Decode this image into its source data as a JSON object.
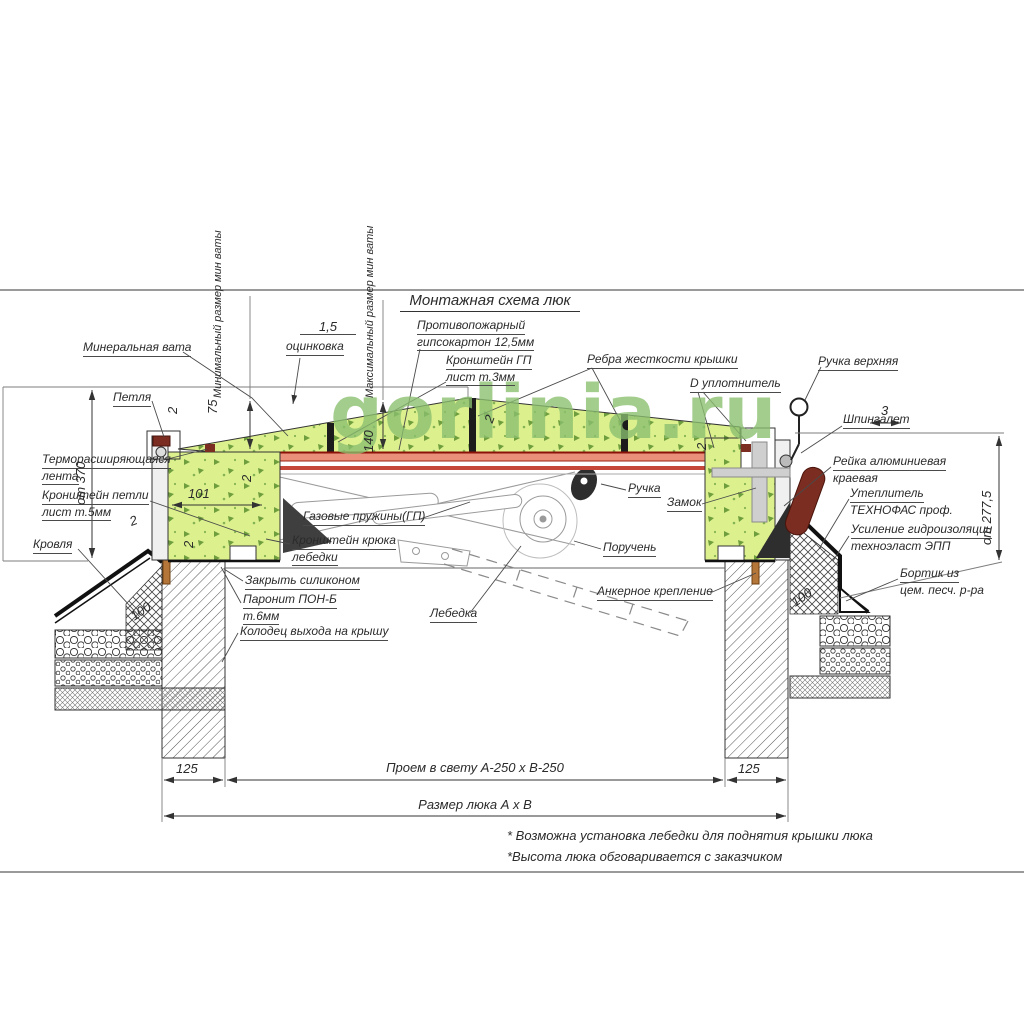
{
  "watermark": "gorlinia.ru",
  "title": "Монтажная схема люк",
  "labels": {
    "mineral_wool": "Минеральная вата",
    "hinge": "Петля",
    "min_size": "Минимальный размер мин ваты",
    "zinc_thickness": "1,5",
    "zinc": "оцинковка",
    "max_size": "Максимальный размер мин ваты",
    "fireproof": [
      "Противопожарный",
      "гипсокартон 12,5мм"
    ],
    "bracket_gp": [
      "Кронштейн ГП",
      "лист т.3мм"
    ],
    "cover_ribs": "Ребра жесткости крышки",
    "d_seal": "D уплотнитель",
    "handle_upper": "Ручка верхняя",
    "latch": "Шпингалет",
    "edge_rail": [
      "Рейка алюминиевая",
      "краевая"
    ],
    "insulation": [
      "Утеплитель",
      "ТЕХНОФАС проф."
    ],
    "waterproofing": [
      "Усиление гидроизоляции",
      "техноэласт ЭПП"
    ],
    "curb": [
      "Бортик из",
      "цем. песч. р-ра"
    ],
    "thermo_tape": [
      "Терморасширяющаяся",
      "лента"
    ],
    "hinge_bracket": [
      "Кронштейн петли",
      "лист т.5мм"
    ],
    "roofing": "Кровля",
    "silicone": "Закрыть силиконом",
    "paronite": [
      "Паронит ПОН-Б",
      "т.6мм"
    ],
    "roof_exit": "Колодец выхода на крышу",
    "gas_springs": "Газовые пружины(ГП)",
    "winch_hook": [
      "Кронштейн крюка",
      "лебедки"
    ],
    "winch": "Лебедка",
    "handle": "Ручка",
    "lock": "Замок",
    "handrail": "Поручень",
    "anchor": "Анкерное крепление"
  },
  "dimensions": {
    "d2": "2",
    "d3": "3",
    "d75": "75",
    "d100": "100",
    "d101": "101",
    "d125": "125",
    "d140": "140",
    "height_left": "от 370",
    "height_right": "от 277,5",
    "opening": "Проем в свету А-250 х В-250",
    "hatch_size": "Размер люка А х В"
  },
  "notes": [
    "* Возможна установка лебедки для поднятия крышки люка",
    "*Высота люка обговаривается с заказчиком"
  ],
  "colors": {
    "mineral_wool_fill": "#dcf18e",
    "wool_speckle": "#6f9e3e",
    "steel_sheet": "#ea8f79",
    "steel_edge": "#9c1f10",
    "handle_grip": "#7a2d20",
    "watermark": "#8abf6e",
    "anchor_bolt": "#b5763a",
    "line": "#333333"
  }
}
